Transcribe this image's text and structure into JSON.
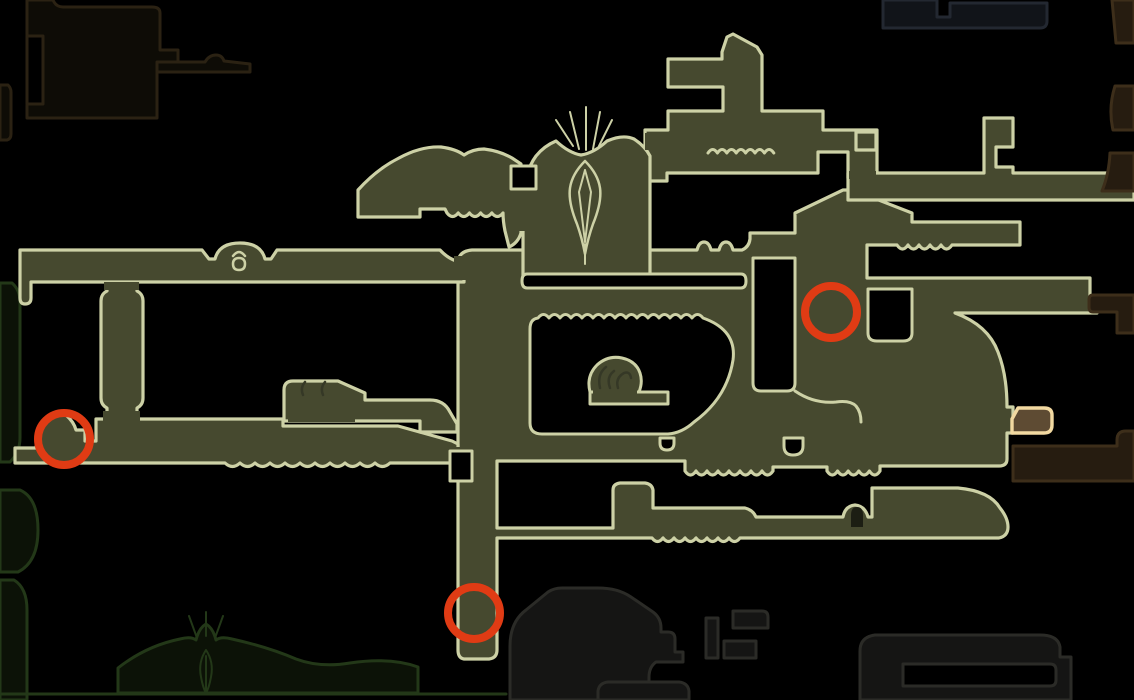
{
  "map": {
    "name": "game-area-map",
    "width": 1134,
    "height": 700,
    "background": "#000000",
    "palette": {
      "explored_fill": "#46492f",
      "explored_stroke": "#cdd1a6",
      "hole_fill": "#000000",
      "dark_brown_fill": "#0e0c06",
      "dark_brown_stroke": "#2b2213",
      "right_brown_fill": "#261c10",
      "right_brown_stroke": "#3d2e1a",
      "green_fill": "#0c1207",
      "green_stroke": "#233818",
      "gray_fill": "#151514",
      "gray_stroke": "#2b2b27",
      "slate_fill": "#111419",
      "slate_stroke": "#232831",
      "glyph_dark": "#353826",
      "door_dark": "#1c1e13",
      "marker_red": "#e03b14",
      "special_fill": "#5e4b33",
      "special_stroke": "#f2d9a1"
    },
    "shapes": [
      {
        "name": "room-unexplored-topleft",
        "f": "dark_brown_fill",
        "s": "dark_brown_stroke",
        "w": 3,
        "d": "M27,0 V118 H157 V72 H178 V50 H160 V13 Q160,7 152,7 H63 Q57,7 54,2 L53,0 Z"
      },
      {
        "name": "corridor-unexplored-topleft-arm",
        "f": "dark_brown_fill",
        "s": "dark_brown_stroke",
        "w": 3,
        "d": "M157,62 H205 Q209,55 216,55 Q222,55 224,61 L250,64 V72 H157 Z"
      },
      {
        "name": "window-unexplored-topleft",
        "f": "hole_fill",
        "s": "dark_brown_stroke",
        "w": 3,
        "d": "M27,36 H43 V104 H27 Z"
      },
      {
        "name": "stub-left-edge-upper",
        "f": "dark_brown_fill",
        "s": "dark_brown_stroke",
        "w": 3,
        "d": "M0,85 H8 Q11,88 11,92 V134 Q11,139 7,140 H0 Z"
      },
      {
        "name": "stub-left-edge-middle",
        "f": "green_fill",
        "s": "green_stroke",
        "w": 3,
        "d": "M0,283 H12 Q20,290 20,302 V438 Q20,452 10,462 H0 Z"
      },
      {
        "name": "stub-left-edge-lower",
        "f": "green_fill",
        "s": "green_stroke",
        "w": 3,
        "d": "M0,490 H20 Q38,498 38,530 Q38,562 18,572 H0 Z"
      },
      {
        "name": "stub-left-edge-bottom",
        "f": "green_fill",
        "s": "green_stroke",
        "w": 3,
        "d": "M0,580 H14 Q27,588 27,610 V700 H0 Z"
      },
      {
        "name": "room-unexplored-bottom-temple",
        "f": "green_fill",
        "s": "green_stroke",
        "w": 3,
        "d": "M118,693 V668 Q146,646 180,639 Q191,636 196,640 Q199,628 206,624 Q213,628 216,640 Q221,636 232,639 Q268,647 296,659 Q320,668 350,663 Q390,657 418,667 V693 Z"
      },
      {
        "name": "ground-line-bottom-left",
        "f": "none",
        "s": "green_stroke",
        "w": 3,
        "d": "M0,694 H506"
      },
      {
        "name": "room-unexplored-bottom-gray",
        "f": "gray_fill",
        "s": "gray_stroke",
        "w": 3,
        "d": "M510,700 V646 Q510,622 526,610 L548,592 Q554,588 562,588 H598 Q618,588 631,597 L653,612 Q661,618 661,628 V632 H668 Q675,632 675,639 V652 H683 V662 H656 Q649,667 649,677 V700 Z"
      },
      {
        "name": "room-unexplored-gray-block-a",
        "f": "gray_fill",
        "s": "gray_stroke",
        "w": 3,
        "d": "M733,611 H762 Q768,611 768,617 V628 H733 Z"
      },
      {
        "name": "room-unexplored-gray-block-b",
        "f": "gray_fill",
        "s": "gray_stroke",
        "w": 3,
        "d": "M706,618 H718 V658 H706 Z"
      },
      {
        "name": "room-unexplored-gray-block-c",
        "f": "gray_fill",
        "s": "gray_stroke",
        "w": 3,
        "d": "M724,641 H756 V658 H724 Z"
      },
      {
        "name": "room-unexplored-gray-small",
        "f": "gray_fill",
        "s": "gray_stroke",
        "w": 3,
        "d": "M598,700 V691 Q599,683 608,682 H679 Q688,683 689,691 V700 Z"
      },
      {
        "name": "room-unexplored-bottomright",
        "f": "gray_fill",
        "s": "gray_stroke",
        "w": 3,
        "d": "M860,700 V651 Q860,637 875,635 H1040 Q1058,635 1060,647 V657 H1071 V700 Z"
      },
      {
        "name": "slot-bottomright",
        "f": "hole_fill",
        "s": "gray_stroke",
        "w": 3,
        "d": "M903,664 H1050 Q1056,664 1056,670 V680 Q1056,686 1050,686 H903 V664 Z"
      },
      {
        "name": "room-unexplored-topright-slate",
        "f": "slate_fill",
        "s": "slate_stroke",
        "w": 3,
        "d": "M883,0 V28 H1040 Q1047,28 1047,21 V3 H950 V17 H937 V0 Z"
      },
      {
        "name": "room-unexplored-topright-corner",
        "f": "right_brown_fill",
        "s": "right_brown_stroke",
        "w": 3,
        "d": "M1112,0 L1116,43 H1134 V0 Z"
      },
      {
        "name": "room-unexplored-right-edge-upper",
        "f": "right_brown_fill",
        "s": "right_brown_stroke",
        "w": 3,
        "d": "M1115,86 H1134 V130 H1113 Q1108,108 1115,86 Z"
      },
      {
        "name": "map-complex-center-right",
        "f": "explored_fill",
        "s": "explored_stroke",
        "w": 3.2,
        "d": "M458,283 V262 Q459,251 472,250 H697 Q699,242 704,242 Q709,242 711,250 H719 Q721,242 726,242 Q731,242 733,250 H742 Q749,247 750,239 V233 H795 V213 L843,190 H853 L912,213 V222 H1020 V245 H952 q-5.5,8 -11,0 q-5.5,8 -11,0 q-5.5,8 -11,0 q-5.5,8 -11,0 q-5.5,8 -11,0 H867 V278 H1090 V296 H1097 V313 H955 Q988,325 998,352 Q1007,375 1007,407 L1013,407 V433 L1007,433 V459 Q1007,466 999,466 H880 V471 q-5.3,8 -10.6,0 q-5.3,8 -10.6,0 q-5.3,8 -10.6,0 q-5.3,8 -10.6,0 q-5.3,8 -10.6,0 V467 H773 V471 q-5.5,8 -11,0 q-5.5,8 -11,0 q-5.5,8 -11,0 q-5.5,8 -11,0 q-5.5,8 -11,0 q-5.5,8 -11,0 q-5.5,8 -11,0 q-5.5,8 -11,0 V461 H497 V528 H613 V490 Q613,484 620,483 H645 Q652,484 653,490 V508 H745 Q753,510 756,517 H843 Q845,506 855,505 Q865,506 868,517 H872 V488 H958 Q990,491 1000,508 Q1008,518 1008,527 Q1008,536 999,538 H740 q-5.5,7 -11,0 q-5.5,7 -11,0 q-5.5,7 -11,0 q-5.5,7 -11,0 q-5.5,7 -11,0 q-5.5,7 -11,0 q-5.5,7 -11,0 q-5.5,7 -11,0 H497 V650 Q497,658 489,659 H464 Q458,658 458,650 Z"
      },
      {
        "name": "room-top-tower",
        "f": "explored_fill",
        "s": "explored_stroke",
        "w": 3.2,
        "d": "M620,152 H645 V130 H668 V111 H723 V87 H668 V59 H722 V52 L727,37 L733,34 L757,47 L762,55 V111 H823 V130 H877 V178 H848 V152 H818 V173 H667 V181 H620 Z"
      },
      {
        "name": "corridor-upper-right",
        "f": "explored_fill",
        "s": "explored_stroke",
        "w": 3.2,
        "d": "M848,173 H984 V118 H1013 V147 H996 V167 H1013 V173 H1134 V200 H848 Z"
      },
      {
        "name": "room-small-square",
        "f": "explored_fill",
        "s": "explored_stroke",
        "w": 3.2,
        "d": "M856,132 H876 V150 H856 Z"
      },
      {
        "name": "corridor-long-left",
        "f": "explored_fill",
        "s": "explored_stroke",
        "w": 3.2,
        "d": "M20,250 H202 L209,259 H215 Q219,243 240,243 Q261,243 265,259 H271 L277,250 H440 Q450,261 464,263 V282 H31 V298 Q31,304 25,304 Q20,304 20,298 Z"
      },
      {
        "name": "pillar-left",
        "f": "explored_fill",
        "s": "explored_stroke",
        "w": 3.2,
        "d": "M107,284 H137 V291 Q143,294 143,301 V398 Q143,405 137,408 V420 H107 V408 Q101,405 101,398 V301 Q101,294 107,291 Z"
      },
      {
        "name": "corridor-bottom-left",
        "f": "explored_fill",
        "s": "explored_stroke",
        "w": 3.2,
        "d": "M15,463 V448 H36 Q39,424 51,415 Q59,408 66,415 Q74,422 76,430 H85 V441 H96 V419 H283 V426 H398 L452,441 L458,444 V463 H390 q-7.5,7 -15,0 q-7.5,7 -15,0 q-7.5,7 -15,0 q-7.5,7 -15,0 q-7.5,7 -15,0 q-7.5,7 -15,0 q-7.5,7 -15,0 q-7.5,7 -15,0 q-7.5,7 -15,0 q-7.5,7 -15,0 q-7.5,7 -15,0 H15 Z"
      },
      {
        "name": "room-small-glyphs",
        "f": "explored_fill",
        "s": "explored_stroke",
        "w": 3.2,
        "d": "M284,421 V390 Q284,381 293,381 H338 L365,393 V400 H430 Q444,400 450,412 L457,424 V432 H420 V421 Z"
      },
      {
        "name": "room-temple",
        "f": "explored_fill",
        "s": "explored_stroke",
        "w": 3.2,
        "d": "M523,278 V205 Q524,172 536,156 Q544,146 556,141 Q569,153 581,155 Q594,153 607,141 Q623,134 634,139 Q645,146 650,156 V278 Z"
      },
      {
        "name": "room-wing",
        "f": "explored_fill",
        "s": "explored_stroke",
        "w": 3.2,
        "d": "M358,190 Q377,169 399,158 Q421,146 441,147 Q456,149 464,155 Q473,149 484,149 Q500,151 512,158 L521,164 V233 Q518,243 509,247 L505,231 Q503,221 503,213 q-5.6,7 -11.2,0 q-5.6,7 -11.2,0 q-5.6,7 -11.2,0 q-5.6,7 -11.2,0 q-5.6,7 -11.2,0 L445,209 H420 V217 H358 Z"
      },
      {
        "name": "seam-patch-corridor-shaft",
        "f": "explored_fill",
        "s": "none",
        "w": 0,
        "d": "M454,256 H470 V280 H454 Z"
      },
      {
        "name": "seam-patch-corridor-shaft-bottom",
        "f": "explored_fill",
        "s": "none",
        "w": 0,
        "d": "M452,447 H468 V461 H452 Z"
      },
      {
        "name": "seam-patch-pillar-bottom",
        "f": "explored_fill",
        "s": "none",
        "w": 0,
        "d": "M103,411 H140 V421 H103 Z"
      },
      {
        "name": "seam-patch-pillar-top",
        "f": "explored_fill",
        "s": "none",
        "w": 0,
        "d": "M104,282 H139 V290 H104 Z"
      },
      {
        "name": "seam-patch-glyphroom",
        "f": "explored_fill",
        "s": "none",
        "w": 0,
        "d": "M288,414 H355 V422 H288 Z"
      },
      {
        "name": "seam-patch-tower-corridor",
        "f": "explored_fill",
        "s": "none",
        "w": 0,
        "d": "M849,171 H876 V179 H849 Z"
      },
      {
        "name": "seam-patch-temple-band",
        "f": "explored_fill",
        "s": "none",
        "w": 0,
        "d": "M645,133 H653 V150 H645 Z"
      },
      {
        "name": "seam-patch-wing-temple",
        "f": "explored_fill",
        "s": "none",
        "w": 0,
        "d": "M517,170 H526 V231 H517 Z"
      },
      {
        "name": "gap-under-temple",
        "f": "hole_fill",
        "s": "explored_stroke",
        "w": 3,
        "d": "M527,274 H741 Q746,274 746,281 Q746,288 741,288 H527 Q522,288 522,281 Q522,274 527,274 Z"
      },
      {
        "name": "gap-inlet-shaft",
        "f": "hole_fill",
        "s": "explored_stroke",
        "w": 3,
        "d": "M753,258 H795 V383 Q795,391 787,391 H761 Q753,391 753,383 Z"
      },
      {
        "name": "gap-right-shaft",
        "f": "hole_fill",
        "s": "explored_stroke",
        "w": 3,
        "d": "M868,289 H912 V333 Q912,341 903,341 H877 Q868,341 868,333 Z"
      },
      {
        "name": "gap-room-interior",
        "f": "hole_fill",
        "s": "explored_stroke",
        "w": 3,
        "d": "M538,318 q5.5,-7 11,0 q5.5,-7 11,0 q5.5,-7 11,0 q5.5,-7 11,0 q5.5,-7 11,0 q5.5,-7 11,0 q5.5,-7 11,0 q5.5,-7 11,0 q5.5,-7 11,0 q5.5,-7 11,0 q5.5,-7 11,0 q5.5,-7 11,0 q5.5,-7 11,0 q5.5,-7 11,0 q5.5,-7 11,0 Q737,330 733,360 Q727,398 694,422 Q682,433 668,434 H542 Q530,434 530,423 V329 Q530,319 538,318 Z"
      },
      {
        "name": "gap-slot-u",
        "f": "hole_fill",
        "s": "explored_stroke",
        "w": 3,
        "d": "M784,438 H803 V446 Q803,455 793,455 Q784,455 784,446 Z"
      },
      {
        "name": "gap-slot-small",
        "f": "hole_fill",
        "s": "explored_stroke",
        "w": 3,
        "d": "M660,438 H674 V443 Q674,450 667,450 Q660,450 660,443 Z"
      },
      {
        "name": "gap-shaft-jog",
        "f": "hole_fill",
        "s": "explored_stroke",
        "w": 3,
        "d": "M450,451 H472 V481 H450 Z"
      },
      {
        "name": "window-wing-temple",
        "f": "hole_fill",
        "s": "explored_stroke",
        "w": 3,
        "d": "M511,166 H536 V189 H511 Z"
      },
      {
        "name": "room-spiral-blob",
        "f": "explored_fill",
        "s": "explored_stroke",
        "w": 3,
        "d": "M590,392 Q586,376 597,365 Q608,355 622,358 Q636,361 640,373 Q643,382 639,392 Z"
      },
      {
        "name": "ledge-spiral",
        "f": "explored_fill",
        "s": "explored_stroke",
        "w": 3,
        "d": "M590,392 H668 V404 H590 Z"
      },
      {
        "name": "seam-patch-spiral",
        "f": "explored_fill",
        "s": "none",
        "w": 0,
        "d": "M593,388 H637 V396 H593 Z"
      },
      {
        "name": "door-arch-dark",
        "f": "door_dark",
        "s": "none",
        "w": 0,
        "d": "M851,527 V515 Q851,507 857,507 Q863,507 863,515 V527 Z"
      },
      {
        "name": "room-unexplored-right-block-mid",
        "f": "right_brown_fill",
        "s": "right_brown_stroke",
        "w": 3,
        "d": "M1110,153 H1134 V191 H1102 Q1109,174 1110,153 Z"
      },
      {
        "name": "room-unexplored-right-block-lower",
        "f": "right_brown_fill",
        "s": "right_brown_stroke",
        "w": 3,
        "d": "M1093,295 H1134 V333 H1117 V312 H1093 Q1089,312 1089,307 V300 Q1089,295 1093,295 Z"
      },
      {
        "name": "corridor-unexplored-bottomright",
        "f": "right_brown_fill",
        "s": "right_brown_stroke",
        "w": 3,
        "d": "M1013,446 H1117 V440 Q1117,431 1126,431 H1134 V481 H1013 Z"
      },
      {
        "name": "room-special-orange",
        "f": "special_fill",
        "s": "special_stroke",
        "w": 3.4,
        "d": "M1012,433 V419 L1018,408 H1044 Q1052,408 1052,415 V425 Q1052,433 1044,433 Z"
      }
    ],
    "decorations": [
      {
        "name": "wavy-line-upper-band",
        "s": "explored_stroke",
        "w": 3,
        "d": "M708,153 q4.7,-7 9.4,0 q4.7,-7 9.4,0 q4.7,-7 9.4,0 q4.7,-7 9.4,0 q4.7,-7 9.4,0 q4.7,-7 9.4,0 q4.7,-7 9.4,0"
      },
      {
        "name": "ledge-under-inlet",
        "s": "explored_stroke",
        "w": 3,
        "d": "M795,391 Q814,404 836,402 Q850,400 856,406 Q861,412 861,422"
      },
      {
        "name": "temple-spike-1",
        "s": "explored_stroke",
        "w": 2,
        "d": "M573,146 L556,120"
      },
      {
        "name": "temple-spike-2",
        "s": "explored_stroke",
        "w": 2,
        "d": "M579,149 L570,112"
      },
      {
        "name": "temple-spike-3",
        "s": "explored_stroke",
        "w": 2,
        "d": "M586,150 L586,107"
      },
      {
        "name": "temple-spike-4",
        "s": "explored_stroke",
        "w": 2,
        "d": "M593,149 L600,112"
      },
      {
        "name": "temple-spike-5",
        "s": "explored_stroke",
        "w": 2,
        "d": "M599,146 L612,120"
      },
      {
        "name": "temple-dagger-glyph",
        "s": "explored_stroke",
        "w": 2.5,
        "d": "M585,161 Q572,174 570,188 Q568,202 577,224 Q582,238 585,254 Q588,238 593,224 Q602,202 600,188 Q598,174 585,161 Z"
      },
      {
        "name": "temple-dagger-inner-left",
        "s": "explored_stroke",
        "w": 2,
        "d": "M585,170 L579,192 L585,242"
      },
      {
        "name": "temple-dagger-inner-right",
        "s": "explored_stroke",
        "w": 2,
        "d": "M585,170 L591,192 L585,242"
      },
      {
        "name": "temple-dagger-tip",
        "s": "explored_stroke",
        "w": 2,
        "d": "M585,244 V264"
      },
      {
        "name": "bell-glyph-arc",
        "s": "explored_stroke",
        "w": 2.5,
        "d": "M233,256 Q239,248 245,256"
      },
      {
        "name": "bell-glyph-circle",
        "s": "explored_stroke",
        "w": 2.5,
        "d": "M239,258 Q245,258 245,264 Q245,270 239,270 Q233,270 233,264 Q233,258 239,258 Z"
      },
      {
        "name": "glyph-hook-1",
        "s": "glyph_dark",
        "w": 2.5,
        "d": "M305,382 Q300,388 303,395"
      },
      {
        "name": "glyph-hook-2",
        "s": "glyph_dark",
        "w": 2.5,
        "d": "M325,382 Q320,388 323,395"
      },
      {
        "name": "spiral-squiggle",
        "s": "glyph_dark",
        "w": 2.5,
        "d": "M600,388 Q597,374 606,367 M610,388 Q606,377 614,371 M618,388 Q615,378 624,373 Q630,371 631,378"
      },
      {
        "name": "green-temple-spike-1",
        "s": "green_stroke",
        "w": 2,
        "d": "M197,638 L189,616"
      },
      {
        "name": "green-temple-spike-2",
        "s": "green_stroke",
        "w": 2,
        "d": "M206,636 L206,612"
      },
      {
        "name": "green-temple-spike-3",
        "s": "green_stroke",
        "w": 2,
        "d": "M215,638 L223,616"
      },
      {
        "name": "green-temple-dagger",
        "s": "green_stroke",
        "w": 2,
        "d": "M206,650 Q198,662 201,677 Q203,688 206,693 Q209,688 211,677 Q214,662 206,650 Z M206,656 V693"
      }
    ],
    "markers": [
      {
        "name": "marker-circle-left",
        "cx": 64,
        "cy": 439,
        "r": 26,
        "stroke_width": 8
      },
      {
        "name": "marker-circle-right",
        "cx": 831,
        "cy": 312,
        "r": 26,
        "stroke_width": 8
      },
      {
        "name": "marker-circle-bottom",
        "cx": 474,
        "cy": 613,
        "r": 26,
        "stroke_width": 8
      }
    ]
  }
}
